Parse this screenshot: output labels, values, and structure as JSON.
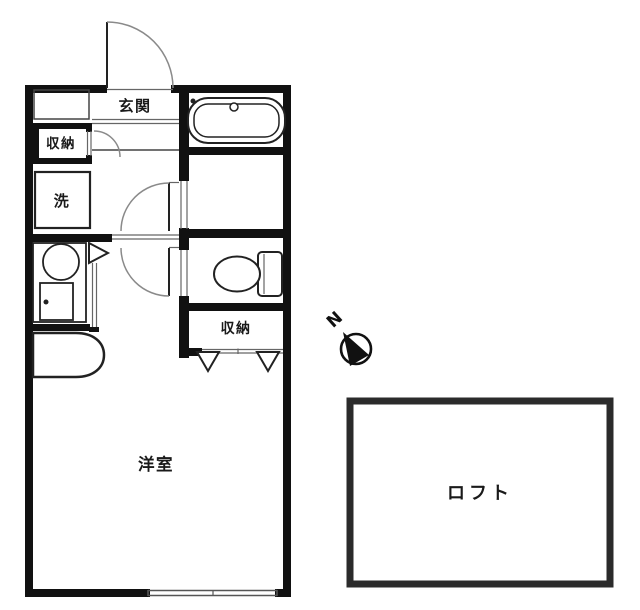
{
  "floorplan": {
    "entrance": {
      "label": "玄関"
    },
    "storage_upper": {
      "label": "収納"
    },
    "laundry": {
      "label": "洗"
    },
    "storage_mid": {
      "label": "収納"
    },
    "main_room": {
      "label": "洋室"
    },
    "loft": {
      "label": "ロフト"
    },
    "compass": {
      "label": "N"
    },
    "colors": {
      "wall": "#111111",
      "fixture_line": "#222222",
      "door_arc": "#8a8a8a",
      "loft_border": "#2b2b2b",
      "background": "#ffffff",
      "label_text": "#1a1a1a"
    }
  }
}
